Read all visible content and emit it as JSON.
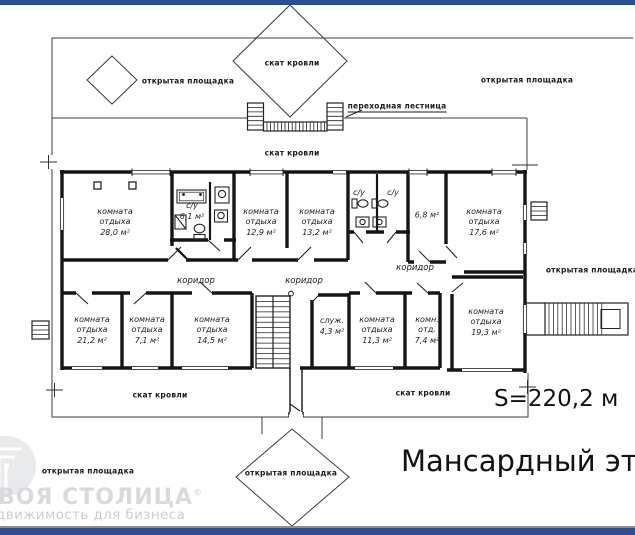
{
  "document": {
    "floor_title": "Мансардный этаж",
    "total_area": "S=220,2 м",
    "accent_color": "#2f4d8d"
  },
  "watermark": {
    "brand_visible": "ВОЯ СТОЛИЦА",
    "registered_mark": "®",
    "tagline_visible": "движимость для бизнеса"
  },
  "plan": {
    "area_labels": {
      "open_area": "открытая площадка",
      "roof_slope": "скат кровли",
      "transition_stair": "переходная лестница"
    },
    "corridor_label": "коридор",
    "rooms": [
      {
        "name": "комната отдыха",
        "area": "28,0 м²"
      },
      {
        "name": "с/у",
        "area": "6,1 м²"
      },
      {
        "name": "комната отдыха",
        "area": "12,9 м²"
      },
      {
        "name": "комната отдыха",
        "area": "13,2 м²"
      },
      {
        "name": "с/у",
        "area": ""
      },
      {
        "name": "с/у",
        "area": ""
      },
      {
        "name": "",
        "area": "6,8 м²"
      },
      {
        "name": "комната отдыха",
        "area": "17,6 м²"
      },
      {
        "name": "комната отдыха",
        "area": "21,2 м²"
      },
      {
        "name": "комната отдыха",
        "area": "7,1 м²"
      },
      {
        "name": "комната отдыха",
        "area": "14,5 м²"
      },
      {
        "name": "служ.",
        "area": "4,3 м²"
      },
      {
        "name": "комната отдыха",
        "area": "11,3 м²"
      },
      {
        "name": "комн. отд.",
        "area": "7,4 м²"
      },
      {
        "name": "комната отдыха",
        "area": "19,3 м²"
      }
    ]
  }
}
